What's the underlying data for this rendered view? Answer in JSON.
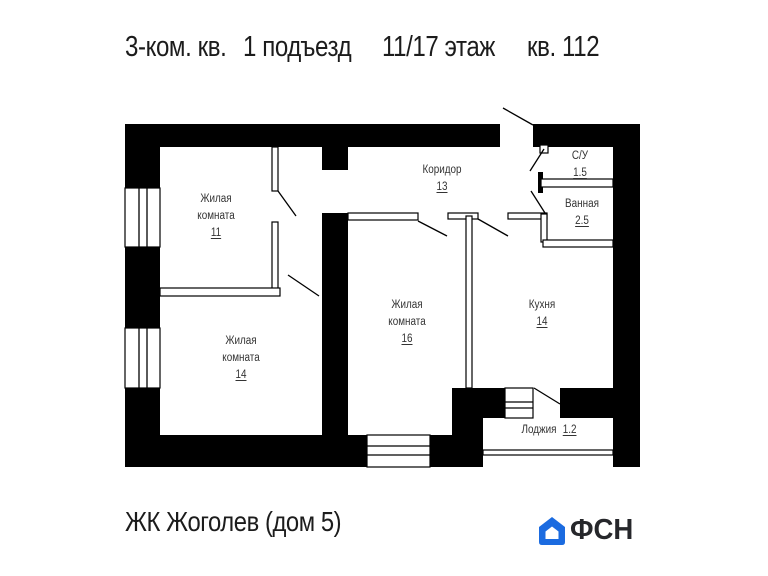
{
  "header": {
    "apartment_type": "3-ком. кв.",
    "entrance": "1 подъезд",
    "floor": "11/17 этаж",
    "unit": "кв. 112"
  },
  "plan": {
    "rooms": {
      "living1": {
        "line1": "Жилая",
        "line2": "комната",
        "area": "11"
      },
      "living2": {
        "line1": "Жилая",
        "line2": "комната",
        "area": "14"
      },
      "living3": {
        "line1": "Жилая",
        "line2": "комната",
        "area": "16"
      },
      "corridor": {
        "line1": "Коридор",
        "area": "13"
      },
      "wc": {
        "line1": "С/У",
        "area": "1.5"
      },
      "bathroom": {
        "line1": "Ванная",
        "area": "2.5"
      },
      "kitchen": {
        "line1": "Кухня",
        "area": "14"
      },
      "loggia": {
        "line1": "Лоджия",
        "area": "1.2"
      }
    }
  },
  "footer": {
    "project_name": "ЖК Жоголев (дом 5)",
    "logo_text": "ФСН"
  },
  "colors": {
    "logo_blue": "#1b6be0",
    "logo_ink": "#26272b",
    "wall_ink": "#000000",
    "label_ink": "#333333"
  }
}
